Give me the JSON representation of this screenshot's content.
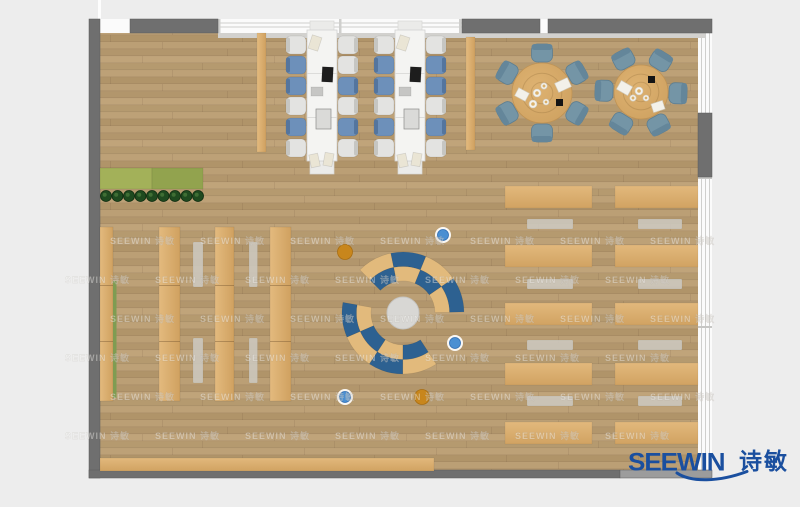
{
  "logo": {
    "latin": "SEEWIN",
    "cn": "诗敏",
    "color": "#1a4f9f"
  },
  "watermark": {
    "text": "SEEWIN 诗敏",
    "color": "rgba(255,255,255,0.40)",
    "rows_y": [
      244,
      283,
      322,
      361,
      400,
      439
    ],
    "x_start_even": 110,
    "x_start_odd": 65,
    "x_step": 90,
    "x_max": 660
  },
  "palette": {
    "bg": "#ededed",
    "wall": "#6f6f6f",
    "wall_light": "#9c9c9c",
    "wall_dark": "#5d5d5d",
    "window": "#fbfbfb",
    "window_line": "#cfcfcd",
    "sill": "#d2d1ce",
    "tan": "#d9ad6c",
    "gray_bench": "#cdc9c0",
    "white_table": "#f4f4f2",
    "chair_blue": "#6d90ba",
    "chair_blue_back": "#54759e",
    "chair_white": "#e3e3e1",
    "chair_white_back": "#c6c6c2",
    "chair_teal": "#7495a6",
    "chair_teal_back": "#64869a",
    "arc_blue": "#2d6191",
    "arc_tan": "#e2ba7c",
    "circle_gray": "#d8d7d4",
    "stool_blue": "#4a8fd2",
    "stool_orange": "#c8861c",
    "plant_green": "#1f4a1f",
    "planter_green_l": "#a3b159",
    "planter_green_r": "#92a34e"
  },
  "plan": {
    "floor": {
      "x": 100,
      "y": 33,
      "w": 598,
      "h": 437
    },
    "walls": [
      {
        "name": "left-wall",
        "x": 89,
        "y": 19,
        "w": 11,
        "h": 459,
        "color": "wall"
      },
      {
        "name": "bottom-wall",
        "x": 89,
        "y": 470,
        "w": 531,
        "h": 8,
        "color": "wall"
      },
      {
        "name": "bottom-wall-e",
        "x": 620,
        "y": 470,
        "w": 92,
        "h": 8,
        "color": "wall_light"
      },
      {
        "name": "top-wall-a",
        "x": 130,
        "y": 19,
        "w": 88,
        "h": 14,
        "color": "wall"
      },
      {
        "name": "top-wall-b",
        "x": 462,
        "y": 19,
        "w": 78,
        "h": 14,
        "color": "wall"
      },
      {
        "name": "top-wall-c",
        "x": 548,
        "y": 19,
        "w": 164,
        "h": 14,
        "color": "wall"
      },
      {
        "name": "right-wall-seg",
        "x": 698,
        "y": 113,
        "w": 14,
        "h": 64,
        "color": "wall"
      }
    ],
    "windows": {
      "top_band": {
        "x": 97,
        "y": 19,
        "w": 615,
        "h": 14
      },
      "top_glass": {
        "x": 218,
        "y": 19,
        "w": 244,
        "h": 14,
        "mullions_x": [
          218,
          339,
          459
        ]
      },
      "right_band": {
        "x": 698,
        "y": 30,
        "w": 14,
        "h": 440,
        "lines_x": [
          701,
          705,
          709
        ],
        "dividers_y": [
          113,
          177,
          326
        ]
      },
      "sill": {
        "x": 218,
        "y": 33,
        "w": 487,
        "h": 5
      },
      "top_left_line": {
        "x": 98,
        "y": 0,
        "w": 3,
        "h": 19
      }
    },
    "planter": {
      "band": {
        "x": 100,
        "y": 168,
        "w": 103,
        "h": 21,
        "split": 52
      },
      "plants": {
        "y": 196,
        "r": 5.5,
        "xs": [
          106,
          117.5,
          129,
          140.5,
          152,
          163.5,
          175,
          186.5,
          198
        ]
      }
    },
    "shelves": {
      "y": 227,
      "h": 174,
      "strips": [
        {
          "x": 100,
          "w": 13
        },
        {
          "x": 159,
          "w": 21
        },
        {
          "x": 215,
          "w": 19
        },
        {
          "x": 270,
          "w": 21
        }
      ],
      "seams_y": [
        285,
        341
      ],
      "green_edge": {
        "x": 113,
        "y": 281,
        "w": 3.5,
        "h": 117
      }
    },
    "aisle_benches": [
      {
        "x": 193,
        "y": 242,
        "w": 10,
        "h": 45
      },
      {
        "x": 249,
        "y": 242,
        "w": 8.5,
        "h": 45
      },
      {
        "x": 193,
        "y": 338,
        "w": 10,
        "h": 45
      },
      {
        "x": 249,
        "y": 338,
        "w": 8.5,
        "h": 45
      }
    ],
    "side_strips": [
      {
        "x": 257,
        "y": 33,
        "w": 9,
        "h": 119
      },
      {
        "x": 466,
        "y": 37,
        "w": 9,
        "h": 113
      }
    ],
    "workstations": [
      {
        "table": {
          "x": 307,
          "y": 30,
          "w": 30,
          "h": 131
        },
        "seams_y": [
          73,
          117
        ],
        "caps": [
          {
            "x": 310,
            "y": 21,
            "w": 24,
            "h": 10
          },
          {
            "x": 310,
            "y": 161,
            "w": 24,
            "h": 13
          }
        ],
        "chair_w": 20,
        "chair_h": 18,
        "chairs_y": [
          36,
          56,
          77,
          97,
          118,
          139
        ],
        "left_x": 286,
        "right_x": 338,
        "left_colors": [
          "white",
          "blue",
          "blue",
          "white",
          "blue",
          "white"
        ],
        "right_colors": [
          "white",
          "white",
          "blue",
          "white",
          "blue",
          "white"
        ],
        "items": [
          {
            "t": "paper",
            "dx": 3,
            "dy": 6,
            "w": 10,
            "h": 14,
            "rot": 18
          },
          {
            "t": "laptop",
            "dx": 15,
            "dy": 37,
            "w": 11,
            "h": 15,
            "rot": 3
          },
          {
            "t": "tablet",
            "dx": 4,
            "dy": 57,
            "w": 12,
            "h": 9,
            "rot": 0
          },
          {
            "t": "monitor",
            "dx": 9,
            "dy": 79,
            "w": 15,
            "h": 20,
            "rot": 0
          },
          {
            "t": "paper",
            "dx": 3,
            "dy": 124,
            "w": 9,
            "h": 13,
            "rot": -12
          },
          {
            "t": "paper",
            "dx": 17,
            "dy": 123,
            "w": 9,
            "h": 13,
            "rot": 10
          }
        ]
      },
      {
        "table": {
          "x": 395,
          "y": 30,
          "w": 30,
          "h": 131
        },
        "seams_y": [
          73,
          117
        ],
        "caps": [
          {
            "x": 398,
            "y": 21,
            "w": 24,
            "h": 10
          },
          {
            "x": 398,
            "y": 161,
            "w": 24,
            "h": 13
          }
        ],
        "chair_w": 20,
        "chair_h": 18,
        "chairs_y": [
          36,
          56,
          77,
          97,
          118,
          139
        ],
        "left_x": 374,
        "right_x": 426,
        "left_colors": [
          "white",
          "blue",
          "blue",
          "white",
          "blue",
          "white"
        ],
        "right_colors": [
          "white",
          "blue",
          "blue",
          "white",
          "blue",
          "white"
        ],
        "items": [
          {
            "t": "paper",
            "dx": 3,
            "dy": 6,
            "w": 10,
            "h": 14,
            "rot": 18
          },
          {
            "t": "laptop",
            "dx": 15,
            "dy": 37,
            "w": 11,
            "h": 15,
            "rot": 3
          },
          {
            "t": "tablet",
            "dx": 4,
            "dy": 57,
            "w": 12,
            "h": 9,
            "rot": 0
          },
          {
            "t": "monitor",
            "dx": 9,
            "dy": 79,
            "w": 15,
            "h": 20,
            "rot": 0
          },
          {
            "t": "paper",
            "dx": 3,
            "dy": 124,
            "w": 9,
            "h": 13,
            "rot": -12
          },
          {
            "t": "paper",
            "dx": 17,
            "dy": 123,
            "w": 9,
            "h": 13,
            "rot": 10
          }
        ]
      }
    ],
    "round_tables": [
      {
        "cx": 542,
        "cy": 93,
        "r": 30,
        "chair_r": 40,
        "chair_angles": [
          -90,
          -30,
          30,
          90,
          150,
          210
        ],
        "papers": [
          {
            "dx": 14,
            "dy": -13,
            "w": 14,
            "h": 10,
            "rot": -25
          },
          {
            "dx": -26,
            "dy": -3,
            "w": 12,
            "h": 9,
            "rot": 28
          }
        ],
        "black": {
          "dx": 14,
          "dy": 6,
          "s": 7
        },
        "cups": [
          {
            "dx": -5,
            "dy": 0,
            "r": 4
          },
          {
            "dx": 2,
            "dy": -7,
            "r": 3.2
          },
          {
            "dx": -9,
            "dy": 11,
            "r": 4
          },
          {
            "dx": 4,
            "dy": 9,
            "r": 3
          }
        ]
      },
      {
        "cx": 641,
        "cy": 92,
        "r": 27,
        "chair_r": 37,
        "chair_angles": [
          -118,
          -58,
          2,
          62,
          122,
          182
        ],
        "papers": [
          {
            "dx": -23,
            "dy": -9,
            "w": 13,
            "h": 10,
            "rot": 30
          },
          {
            "dx": 11,
            "dy": 10,
            "w": 12,
            "h": 9,
            "rot": -18
          }
        ],
        "black": {
          "dx": 7,
          "dy": -16,
          "s": 7
        },
        "cups": [
          {
            "dx": -2,
            "dy": -1,
            "r": 4
          },
          {
            "dx": 5,
            "dy": 6,
            "r": 3
          },
          {
            "dx": -8,
            "dy": 6,
            "r": 3.2
          }
        ]
      }
    ],
    "lounge": {
      "cx": 403,
      "cy": 313,
      "center_r": 16,
      "r_inner": 32,
      "r_mid": 46.5,
      "r_outer": 61,
      "arcs": [
        {
          "a1": 225,
          "a2": 359,
          "outer": [
            "tan",
            "blue",
            "tan",
            "blue"
          ],
          "inner": [
            "blue",
            "tan",
            "blue",
            "tan"
          ]
        },
        {
          "a1": 57,
          "a2": 190,
          "outer": [
            "tan",
            "blue",
            "tan",
            "blue"
          ],
          "inner": [
            "blue",
            "tan",
            "blue",
            "tan"
          ]
        }
      ],
      "stools": [
        {
          "x": 345,
          "y": 252,
          "c": "orange"
        },
        {
          "x": 443,
          "y": 235,
          "c": "blue"
        },
        {
          "x": 455,
          "y": 343,
          "c": "blue"
        },
        {
          "x": 345,
          "y": 397,
          "c": "blue"
        },
        {
          "x": 422,
          "y": 397,
          "c": "orange"
        }
      ]
    },
    "reading_area": {
      "rows_y": [
        186,
        245,
        303,
        363,
        422
      ],
      "row_h": 22,
      "bench_y": [
        219,
        279,
        340,
        396
      ],
      "bench_h": 10,
      "columns": [
        {
          "row_x": 505,
          "row_w": 87,
          "bench_x": 527,
          "bench_w": 46
        },
        {
          "row_x": 615,
          "row_w": 83,
          "bench_x": 638,
          "bench_w": 44
        }
      ]
    },
    "bottom_bench": {
      "x": 100,
      "y": 458,
      "w": 334,
      "h": 13
    }
  }
}
